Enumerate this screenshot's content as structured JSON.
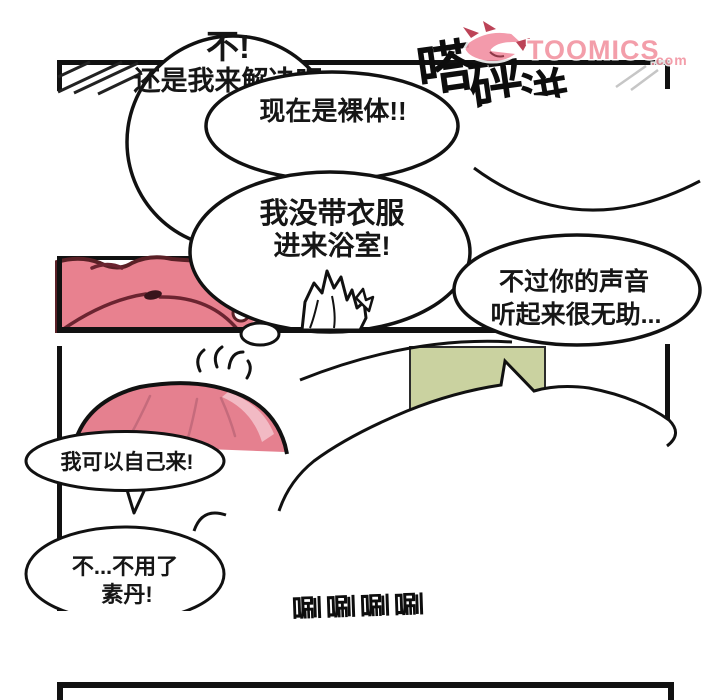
{
  "page": {
    "kind_label": "comic-page"
  },
  "logo": {
    "name": "TOOMICS",
    "tld": ".com",
    "color": "#f2919f"
  },
  "bubbles": {
    "b1": {
      "lines": [
        "不!",
        "还是我来解决吧"
      ]
    },
    "b2": {
      "lines": [
        "现在是裸体!!"
      ]
    },
    "b3": {
      "lines": [
        "我没带衣服",
        "进来浴室!"
      ]
    },
    "b4": {
      "lines": [
        "不过你的声音",
        "听起来很无助..."
      ]
    },
    "b5": {
      "lines": [
        "我可以自己来!"
      ]
    },
    "b6": {
      "lines": [
        "不...不用了",
        "素丹!"
      ]
    }
  },
  "sfx": {
    "top": [
      "嗒",
      "砰",
      "洴"
    ],
    "bottom": "唰唰唰唰"
  },
  "colors": {
    "ink": "#161616",
    "peach_pink": "#e8818f",
    "peach_light": "#f4b6c0",
    "peach_outline": "#5a2026",
    "hair_pink": "#e5808f",
    "hair_light": "#f2bac4",
    "door_green": "#cad2a0",
    "logo_pink": "#f2919f"
  }
}
